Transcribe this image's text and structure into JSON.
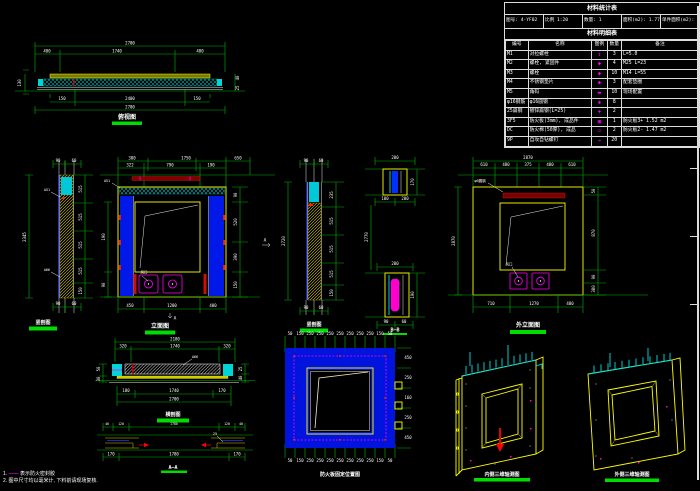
{
  "table": {
    "title": "材料统计表",
    "info": [
      "图号: 4-YF02",
      "比例 1:20",
      "数量: 1",
      "面积(m2): 1.77",
      "单件面积(m2): 1.21"
    ],
    "subtitle": "材料明细表",
    "headers": [
      "编号",
      "名称",
      "图例",
      "数量",
      "备注"
    ],
    "rows": [
      {
        "no": "M1",
        "name": "对拉螺栓",
        "sym": "↕",
        "qty": "3",
        "note": "L=5.0"
      },
      {
        "no": "M2",
        "name": "螺栓, 紧固件",
        "sym": "◆",
        "qty": "4",
        "note": "M25  L=23"
      },
      {
        "no": "M3",
        "name": "螺栓",
        "sym": "◆",
        "qty": "10",
        "note": "M14  L=55"
      },
      {
        "no": "M4",
        "name": "不锈钢垫片",
        "sym": "◆",
        "qty": "3",
        "note": "配套垫圈"
      },
      {
        "no": "M5",
        "name": "角码",
        "sym": "▬",
        "qty": "10",
        "note": "现场配置"
      },
      {
        "no": "φ16钢筋",
        "name": "φ16圆钢",
        "sym": "✱",
        "qty": "8",
        "note": ""
      },
      {
        "no": "25扁钢",
        "name": "镀锌扁钢(L=25)",
        "sym": "✚",
        "qty": "2",
        "note": ""
      },
      {
        "no": "3F5",
        "name": "防火板(3mm), 成品件",
        "sym": "▣",
        "qty": "1",
        "note": "防火板3+  1.52 m2"
      },
      {
        "no": "DC",
        "name": "防火棉(50厚), 成品",
        "sym": "▭",
        "qty": "2",
        "note": "防火板2-  1.47 m2"
      },
      {
        "no": "9P",
        "name": "自攻自钻螺钉",
        "sym": "➔",
        "qty": "20",
        "note": ""
      }
    ]
  },
  "notes": {
    "n1_no": "1.",
    "n1_sym": "——",
    "n1_text": "表示防火密封胶",
    "n2": "2. 图中尺寸均以毫米计, 下料前请现场复核."
  },
  "drawings": {
    "top_plan": {
      "label": "俯视图",
      "dims": [
        "2700",
        "480",
        "1740",
        "480",
        "150",
        "2400",
        "150",
        "2700",
        "130",
        "40",
        "25"
      ]
    },
    "left_section": {
      "label": "竖剖图",
      "dims": [
        "90",
        "60",
        "2345",
        "515",
        "515",
        "515",
        "515",
        "150",
        "90",
        "60"
      ],
      "leaders": [
        "A51",
        "A66"
      ]
    },
    "center_elevation": {
      "label": "立面图",
      "dims": [
        "300",
        "1750",
        "650",
        "322",
        "790",
        "190",
        "90",
        "520",
        "390",
        "150",
        "190",
        "90",
        "450",
        "1200",
        "400"
      ],
      "leader": "A51",
      "fan": "风口",
      "mark": "A"
    },
    "mid_section": {
      "label": "竖剖图",
      "dims": [
        "90",
        "60",
        "2720",
        "235",
        "515",
        "515",
        "515",
        "150"
      ]
    },
    "bb_detail": {
      "label": "B—B",
      "dims": [
        "200",
        "170",
        "100",
        "2770",
        "200",
        "190",
        "90",
        "60"
      ]
    },
    "right_elevation": {
      "label": "外立面图",
      "dims": [
        "2870",
        "610",
        "480",
        "375",
        "480",
        "610",
        "2870",
        "50",
        "870",
        "90",
        "380",
        "710",
        "1270",
        "480"
      ],
      "leader": "φ6圆钢",
      "fan": "风口"
    },
    "bottom_section": {
      "label": "横剖图",
      "dims": [
        "2180",
        "320",
        "1740",
        "320",
        "50",
        "30",
        "25",
        "40",
        "180",
        "1740",
        "170",
        "2700"
      ],
      "leader": "A66"
    },
    "aa_section": {
      "label": "A—A",
      "dims": [
        "40",
        "120",
        "1780",
        "120",
        "40",
        "170",
        "1780",
        "170"
      ],
      "leader": "25"
    },
    "blue_panel": {
      "label": "防火板固定位置图",
      "bticks": [
        "50",
        "150",
        "250",
        "250",
        "250",
        "250",
        "250",
        "250",
        "250",
        "150",
        "50"
      ],
      "rticks": [
        "450",
        "250",
        "160",
        "250",
        "450"
      ]
    },
    "axo_inner": {
      "label": "内侧三维轴测图"
    },
    "axo_outer": {
      "label": "外侧三维轴测图"
    }
  }
}
